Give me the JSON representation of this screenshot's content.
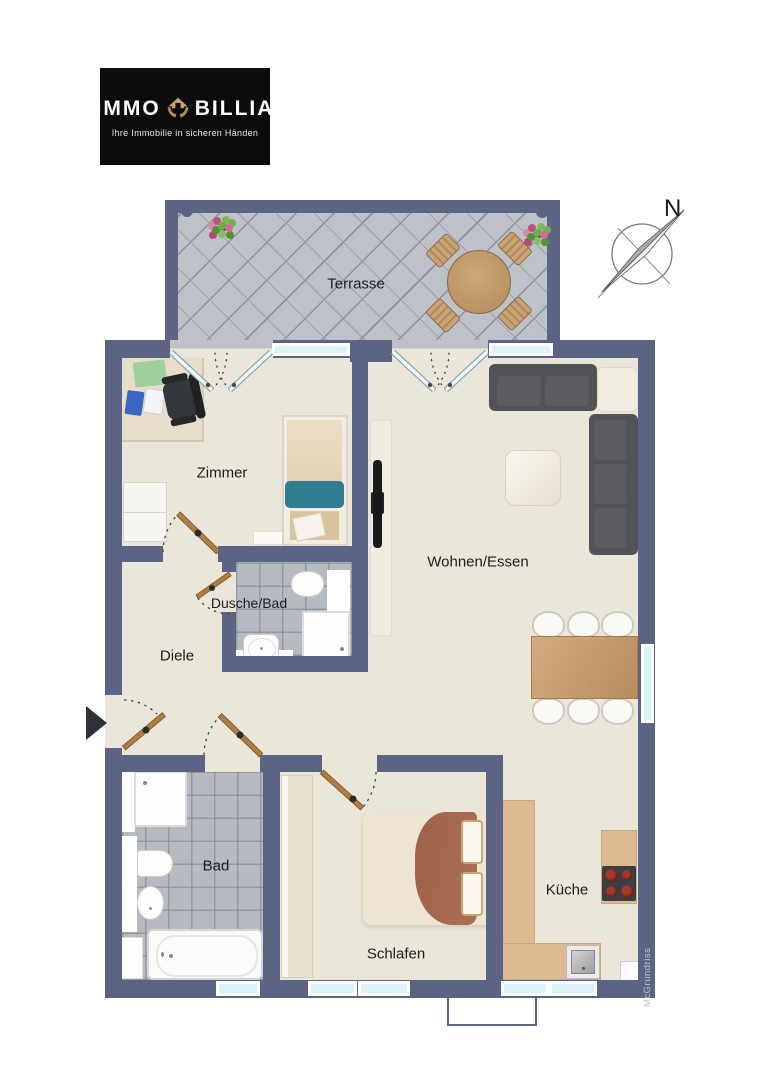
{
  "logo": {
    "brand_left": "IMMO",
    "brand_right": "BILLIA",
    "tagline": "Ihre Immobilie in sicheren Händen",
    "background": "#0c0c0c",
    "gold": "#b98f5a"
  },
  "compass": {
    "north_label": "N"
  },
  "rooms": {
    "terrasse": {
      "label": "Terrasse"
    },
    "zimmer": {
      "label": "Zimmer"
    },
    "wohnen_essen": {
      "label": "Wohnen/Essen"
    },
    "dusche_bad": {
      "label": "Dusche/Bad"
    },
    "diele": {
      "label": "Diele"
    },
    "bad": {
      "label": "Bad"
    },
    "schlafen": {
      "label": "Schlafen"
    },
    "kueche": {
      "label": "Küche"
    }
  },
  "watermark": {
    "text": "McGrundriss"
  },
  "icons": {
    "logo_mark": "house-in-hands",
    "compass": "compass-rose-needle",
    "entrance": "solid-right-arrow"
  },
  "colors": {
    "wall": "#5c6483",
    "floor": "#ebe6da",
    "terrace_tile": "#bdc2c8",
    "bath_tile": "#b6bbc2",
    "window_glass": "#d9f4f6",
    "kitchen_counter": "#d9b88e",
    "door_wood": "#b07c3f",
    "sofa": "#515356",
    "blanket_teal": "#2e7e8f",
    "blanket_brown": "#a0654c",
    "table_wood": "#c9a271"
  }
}
